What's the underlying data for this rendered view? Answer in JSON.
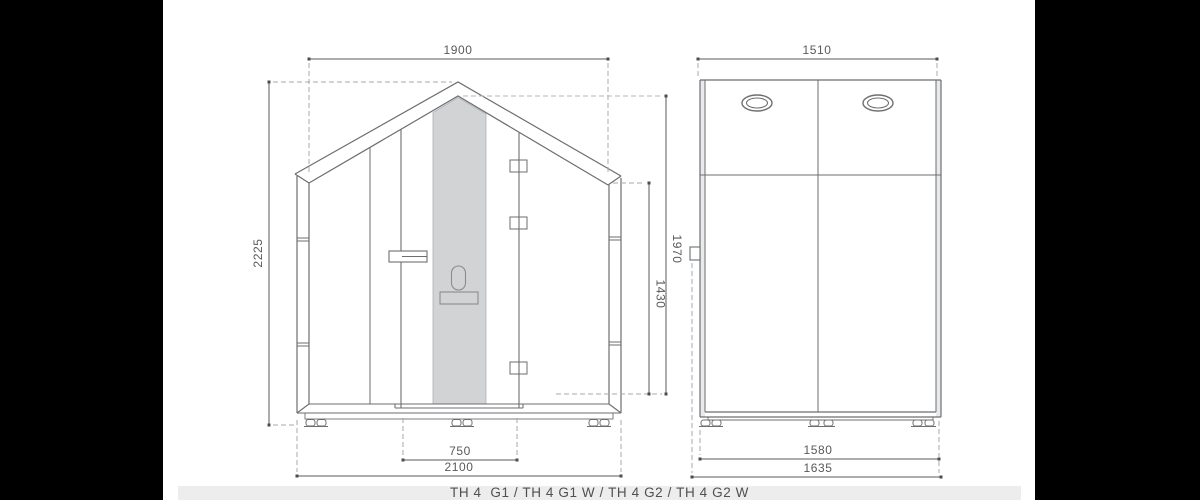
{
  "caption": {
    "models": "TH 4  G1 / TH 4 G1 W / TH 4 G2 / TH 4 G2 W"
  },
  "front_view": {
    "description": "front elevation of pitched-roof acoustic booth with glass door",
    "dimensions": {
      "roof_width": "1900",
      "total_height": "2225",
      "interior_peak_height": "1970",
      "interior_wall_height": "1430",
      "door_width": "750",
      "total_width": "2100"
    }
  },
  "side_view": {
    "description": "side elevation with two ceiling vents",
    "dimensions": {
      "top_width": "1510",
      "body_depth": "1580",
      "total_depth": "1635"
    }
  },
  "colors": {
    "drawing_line": "#6d6e70",
    "dimension_line": "#58595b",
    "dashed_line": "#a6a8ab",
    "glass_fill": "#d2d3d4",
    "panel_strip_fill": "#e9eaeb",
    "caption_background": "#ededee",
    "caption_text": "#4f5052",
    "side_bars": "#000000",
    "background": "#ffffff"
  }
}
